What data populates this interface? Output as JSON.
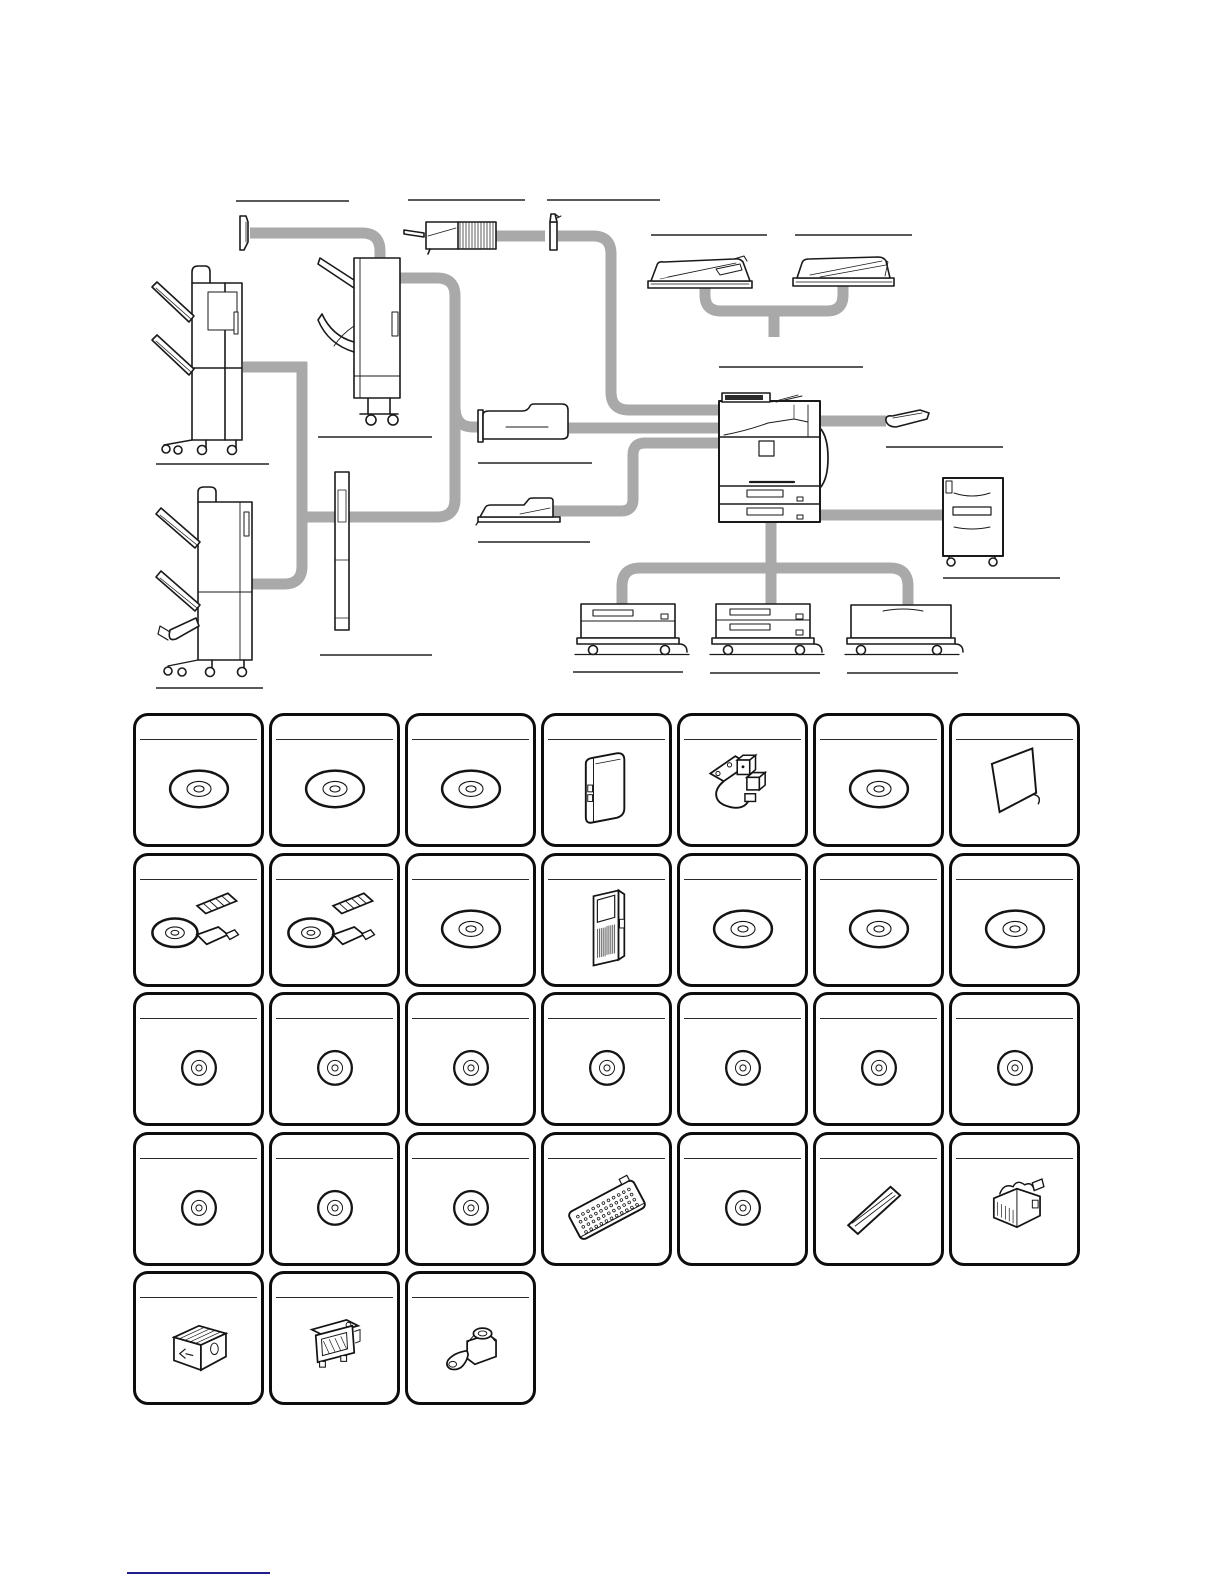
{
  "page": {
    "width": 1224,
    "height": 1584,
    "background": "#ffffff"
  },
  "colors": {
    "connector_gray": "#a9a9a9",
    "line_art": "#1a1a1a",
    "card_border": "#0d0d0d",
    "label_rule": "#222222",
    "footnote_rule": "#221e8c"
  },
  "diagram": {
    "devices": [
      {
        "id": "finisher",
        "name": "finisher"
      },
      {
        "id": "job-separator",
        "name": "job-separator"
      },
      {
        "id": "inner-finisher",
        "name": "inner-finisher"
      },
      {
        "id": "scanner-lamp-unit",
        "name": "scanner-lamp-unit"
      },
      {
        "id": "attachment-kit",
        "name": "attachment-kit"
      },
      {
        "id": "document-feeder",
        "name": "reversing-auto-document-feeder"
      },
      {
        "id": "document-cover",
        "name": "document-cover"
      },
      {
        "id": "main-unit",
        "name": "main-unit"
      },
      {
        "id": "exit-tray",
        "name": "exit-tray"
      },
      {
        "id": "high-cabinet",
        "name": "high-cabinet"
      },
      {
        "id": "paper-pass-unit",
        "name": "paper-pass-unit"
      },
      {
        "id": "exit-tray-cabinet",
        "name": "exit-tray-cabinet"
      },
      {
        "id": "saddle-stitch-finisher",
        "name": "saddle-stitch-finisher"
      },
      {
        "id": "punch-module",
        "name": "punch-module"
      },
      {
        "id": "one-drawer-stand",
        "name": "one-drawer-stand"
      },
      {
        "id": "two-drawer-stand",
        "name": "two-drawer-stand"
      },
      {
        "id": "low-stand",
        "name": "low-stand"
      }
    ],
    "label_rules": [
      {
        "for": "job-separator",
        "x": 236,
        "y": 201,
        "w": 113
      },
      {
        "for": "scanner-lamp-unit",
        "x": 408,
        "y": 200,
        "w": 117
      },
      {
        "for": "attachment-kit",
        "x": 547,
        "y": 200,
        "w": 113
      },
      {
        "for": "document-feeder",
        "x": 651,
        "y": 235,
        "w": 116
      },
      {
        "for": "document-cover",
        "x": 795,
        "y": 235,
        "w": 117
      },
      {
        "for": "main-unit",
        "x": 719,
        "y": 367,
        "w": 144
      },
      {
        "for": "finisher",
        "x": 156,
        "y": 464,
        "w": 113
      },
      {
        "for": "inner-finisher",
        "x": 318,
        "y": 437,
        "w": 114
      },
      {
        "for": "exit-tray",
        "x": 886,
        "y": 447,
        "w": 117
      },
      {
        "for": "paper-pass-unit",
        "x": 478,
        "y": 463,
        "w": 114
      },
      {
        "for": "exit-tray-cabinet",
        "x": 478,
        "y": 542,
        "w": 112
      },
      {
        "for": "high-cabinet",
        "x": 943,
        "y": 578,
        "w": 117
      },
      {
        "for": "punch-module",
        "x": 320,
        "y": 655,
        "w": 112
      },
      {
        "for": "saddle-stitch-finisher",
        "x": 156,
        "y": 688,
        "w": 107
      },
      {
        "for": "one-drawer-stand",
        "x": 573,
        "y": 672,
        "w": 110
      },
      {
        "for": "two-drawer-stand",
        "x": 710,
        "y": 673,
        "w": 110
      },
      {
        "for": "low-stand",
        "x": 847,
        "y": 673,
        "w": 111
      }
    ]
  },
  "options_grid": {
    "grid": {
      "origin_x": 133,
      "origin_y": 713,
      "pitch_x": 136,
      "pitch_y": 139.5,
      "card_w": 131,
      "card_h": 134,
      "radius": 15,
      "border_px": 3,
      "title_rule_top": 23
    },
    "cards": [
      {
        "row": 1,
        "col": 1,
        "icon": "cd-ellipse",
        "name": "software-cd"
      },
      {
        "row": 1,
        "col": 2,
        "icon": "cd-ellipse",
        "name": "software-cd"
      },
      {
        "row": 1,
        "col": 3,
        "icon": "cd-ellipse",
        "name": "software-cd"
      },
      {
        "row": 1,
        "col": 4,
        "icon": "wireless-adapter",
        "name": "wireless-lan-adapter"
      },
      {
        "row": 1,
        "col": 5,
        "icon": "cable-bracket",
        "name": "connection-cable-kit"
      },
      {
        "row": 1,
        "col": 6,
        "icon": "cd-ellipse",
        "name": "software-cd"
      },
      {
        "row": 1,
        "col": 7,
        "icon": "separator-panel",
        "name": "separator-panel"
      },
      {
        "row": 2,
        "col": 1,
        "icon": "license-kit",
        "name": "license-kit-cd-usb"
      },
      {
        "row": 2,
        "col": 2,
        "icon": "license-kit",
        "name": "license-kit-cd-usb"
      },
      {
        "row": 2,
        "col": 3,
        "icon": "cd-ellipse",
        "name": "software-cd"
      },
      {
        "row": 2,
        "col": 4,
        "icon": "expansion-board",
        "name": "fax-expansion-board"
      },
      {
        "row": 2,
        "col": 5,
        "icon": "cd-ellipse",
        "name": "software-cd"
      },
      {
        "row": 2,
        "col": 6,
        "icon": "cd-ellipse",
        "name": "software-cd"
      },
      {
        "row": 2,
        "col": 7,
        "icon": "cd-ellipse",
        "name": "software-cd"
      },
      {
        "row": 3,
        "col": 1,
        "icon": "cd-circle",
        "name": "software-cd"
      },
      {
        "row": 3,
        "col": 2,
        "icon": "cd-circle",
        "name": "software-cd"
      },
      {
        "row": 3,
        "col": 3,
        "icon": "cd-circle",
        "name": "software-cd"
      },
      {
        "row": 3,
        "col": 4,
        "icon": "cd-circle",
        "name": "software-cd"
      },
      {
        "row": 3,
        "col": 5,
        "icon": "cd-circle",
        "name": "software-cd"
      },
      {
        "row": 3,
        "col": 6,
        "icon": "cd-circle",
        "name": "software-cd"
      },
      {
        "row": 3,
        "col": 7,
        "icon": "cd-circle",
        "name": "software-cd"
      },
      {
        "row": 4,
        "col": 1,
        "icon": "cd-circle",
        "name": "software-cd"
      },
      {
        "row": 4,
        "col": 2,
        "icon": "cd-circle",
        "name": "software-cd"
      },
      {
        "row": 4,
        "col": 3,
        "icon": "cd-circle",
        "name": "software-cd"
      },
      {
        "row": 4,
        "col": 4,
        "icon": "keyboard",
        "name": "keyboard"
      },
      {
        "row": 4,
        "col": 5,
        "icon": "cd-circle",
        "name": "software-cd"
      },
      {
        "row": 4,
        "col": 6,
        "icon": "stamp-glass",
        "name": "stamp-glass-plate"
      },
      {
        "row": 4,
        "col": 7,
        "icon": "staple-cartridges",
        "name": "staple-cartridge-set"
      },
      {
        "row": 5,
        "col": 1,
        "icon": "staple-cartridge-box",
        "name": "staple-cartridge-box"
      },
      {
        "row": 5,
        "col": 2,
        "icon": "staple-unit",
        "name": "staple-unit"
      },
      {
        "row": 5,
        "col": 3,
        "icon": "stamp-cartridge",
        "name": "stamp-cartridge"
      }
    ]
  },
  "footnote": {
    "rule": {
      "x": 127,
      "y": 1572,
      "w": 143,
      "thickness": 2
    }
  }
}
